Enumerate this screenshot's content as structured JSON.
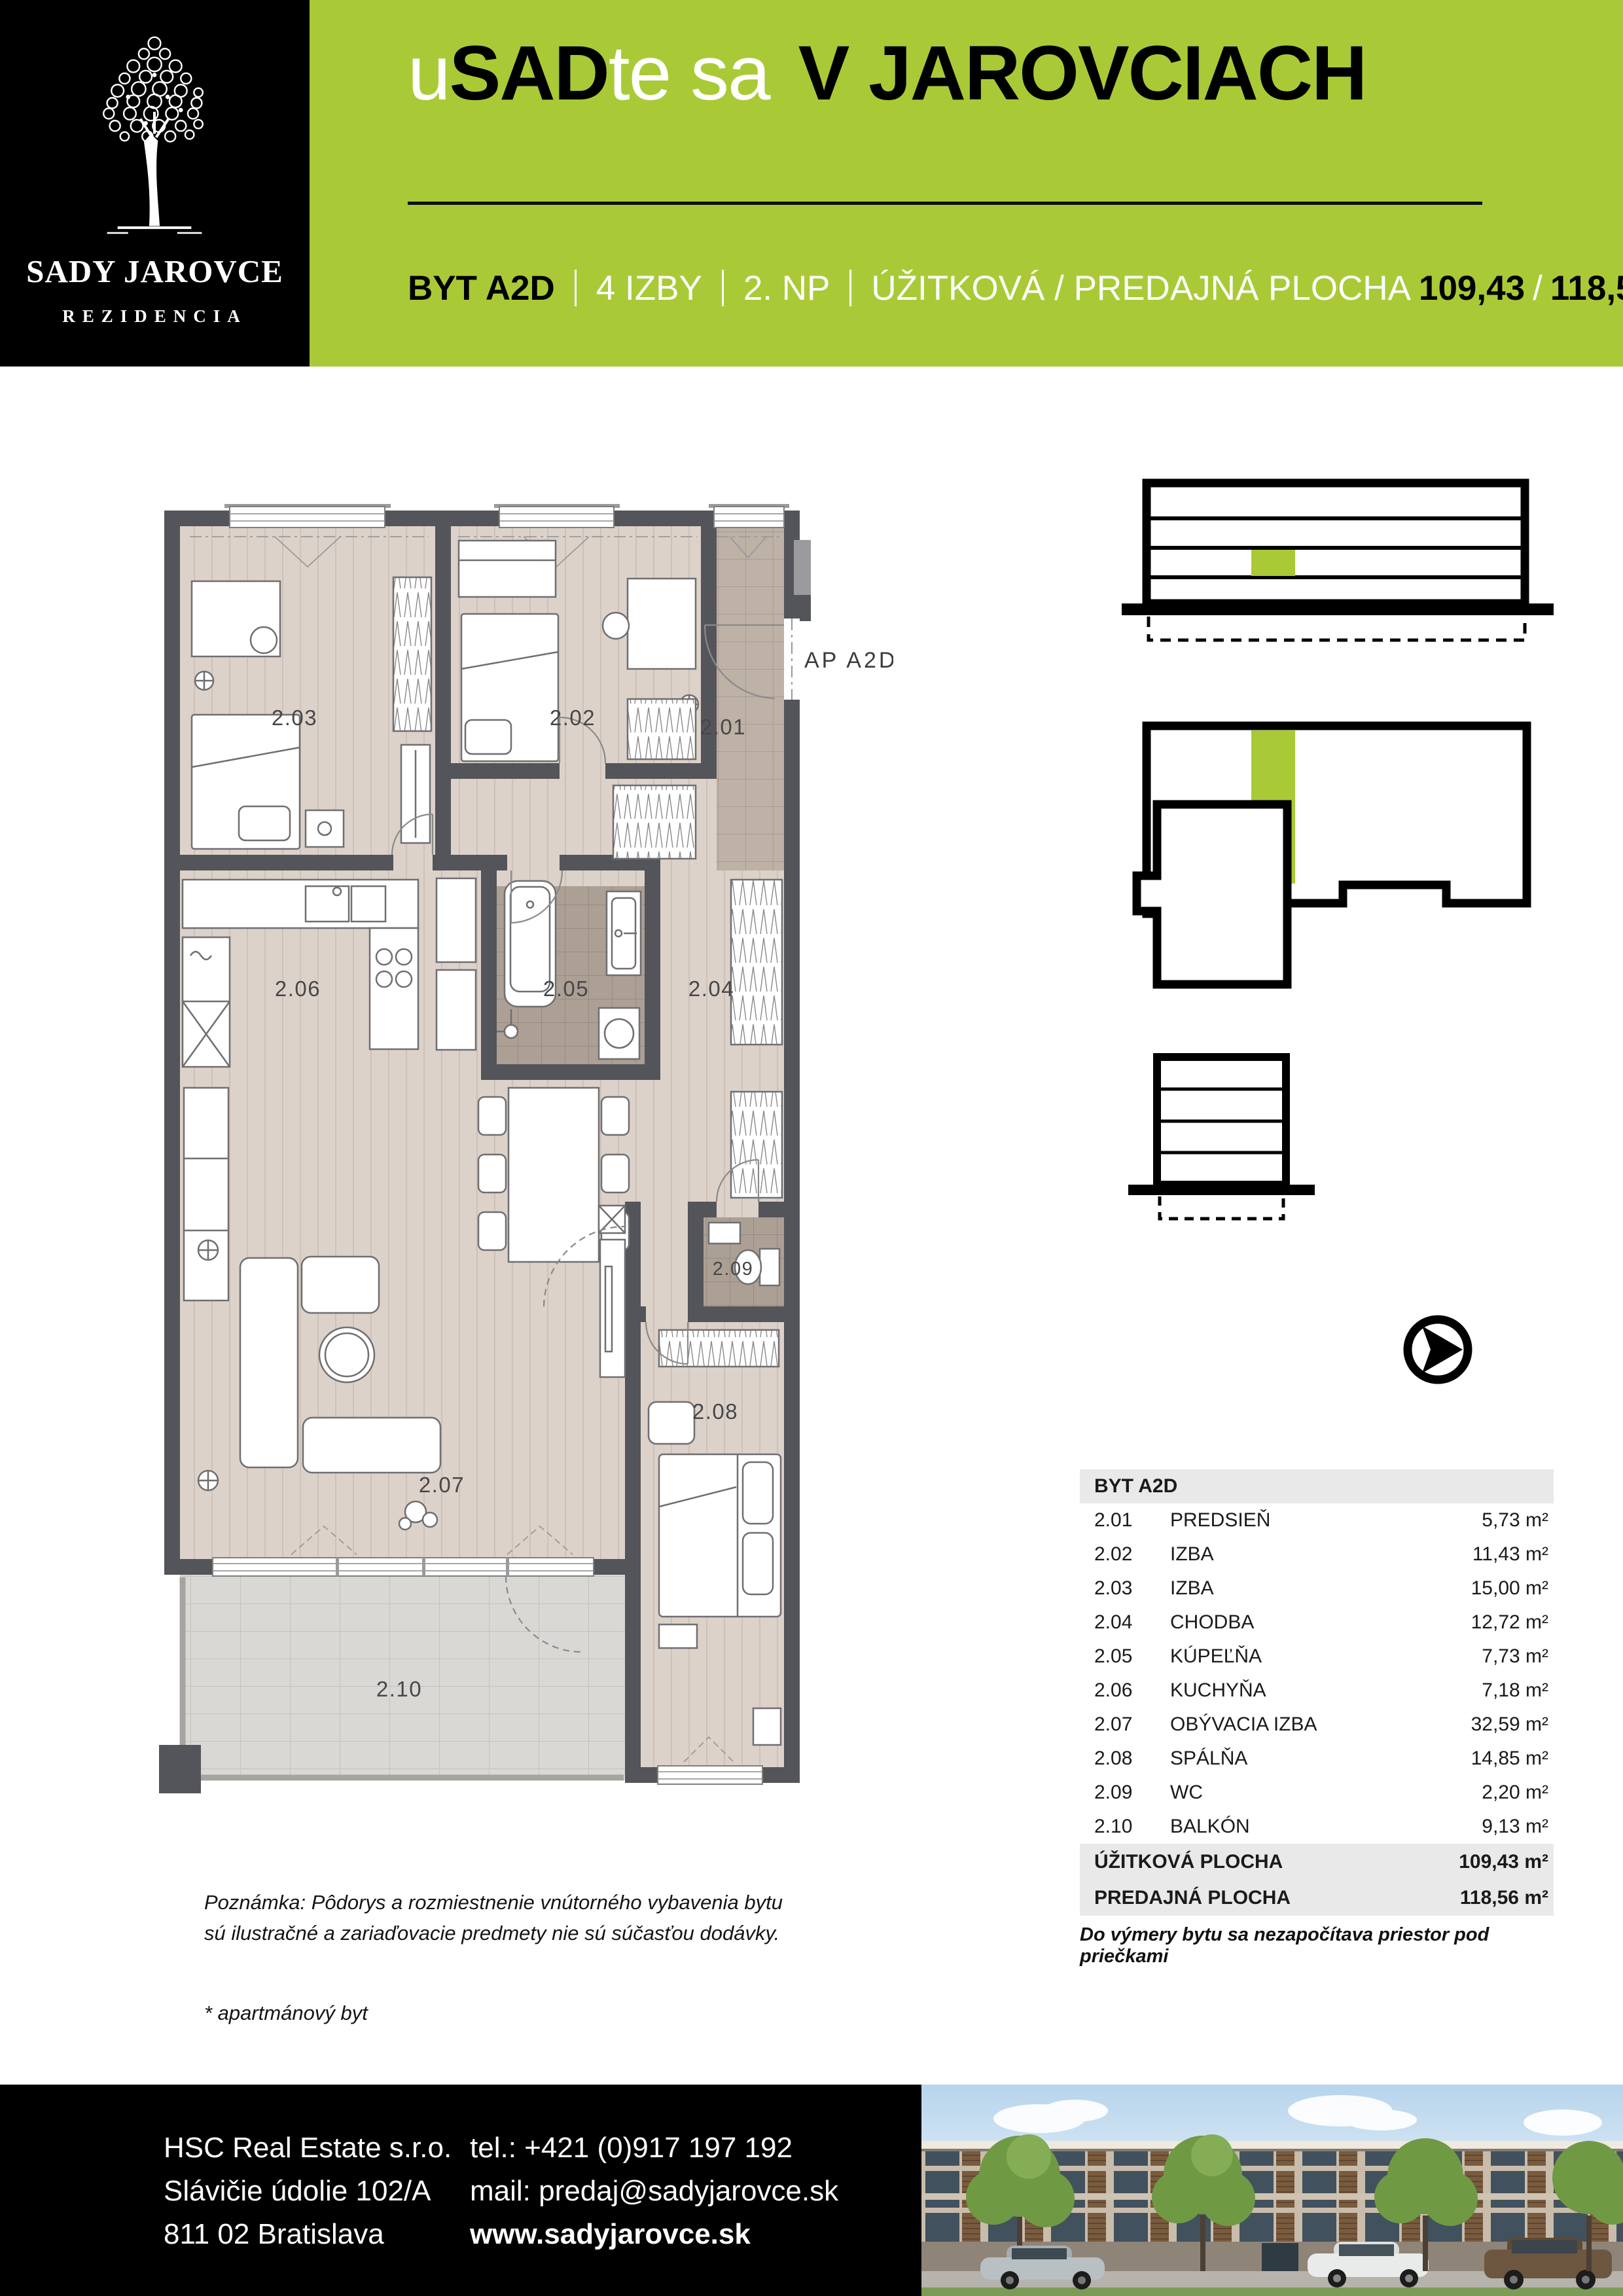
{
  "brand": {
    "logo_name": "SADY JAROVCE",
    "logo_subtitle": "REZIDENCIA",
    "green": "#a9ca36",
    "black": "#000000"
  },
  "header": {
    "title_u": "u",
    "title_sad": "SAD",
    "title_tesa": "te sa",
    "title_main": "V JAROVCIACH",
    "unit": "BYT A2D",
    "rooms": "4 IZBY",
    "floor": "2. NP",
    "area_label": "ÚŽITKOVÁ / PREDAJNÁ PLOCHA",
    "area_value_1": "109,43",
    "area_slash": "/",
    "area_value_2": "118,56 m²"
  },
  "plan": {
    "ap_label": "AP A2D",
    "rooms": [
      {
        "id": "2.01"
      },
      {
        "id": "2.02"
      },
      {
        "id": "2.03"
      },
      {
        "id": "2.04"
      },
      {
        "id": "2.05"
      },
      {
        "id": "2.06"
      },
      {
        "id": "2.07"
      },
      {
        "id": "2.08"
      },
      {
        "id": "2.09"
      },
      {
        "id": "2.10"
      }
    ]
  },
  "table": {
    "title": "BYT A2D",
    "rows": [
      {
        "code": "2.01",
        "name": "PREDSIEŇ",
        "area": "5,73 m²"
      },
      {
        "code": "2.02",
        "name": "IZBA",
        "area": "11,43 m²"
      },
      {
        "code": "2.03",
        "name": "IZBA",
        "area": "15,00 m²"
      },
      {
        "code": "2.04",
        "name": "CHODBA",
        "area": "12,72 m²"
      },
      {
        "code": "2.05",
        "name": "KÚPEĽŇA",
        "area": "7,73 m²"
      },
      {
        "code": "2.06",
        "name": "KUCHYŇA",
        "area": "7,18 m²"
      },
      {
        "code": "2.07",
        "name": "OBÝVACIA IZBA",
        "area": "32,59 m²"
      },
      {
        "code": "2.08",
        "name": "SPÁLŇA",
        "area": "14,85 m²"
      },
      {
        "code": "2.09",
        "name": "WC",
        "area": "2,20 m²"
      },
      {
        "code": "2.10",
        "name": "BALKÓN",
        "area": "9,13 m²"
      }
    ],
    "totals": [
      {
        "label": "ÚŽITKOVÁ PLOCHA",
        "area": "109,43 m²"
      },
      {
        "label": "PREDAJNÁ PLOCHA",
        "area": "118,56 m²"
      }
    ],
    "footnote": "Do výmery bytu sa nezapočítava priestor pod priečkami"
  },
  "notes": {
    "line1": "Poznámka: Pôdorys a rozmiestnenie vnútorného vybavenia bytu",
    "line2": "sú ilustračné a zariaďovacie predmety nie sú súčasťou dodávky.",
    "apartment": "* apartmánový byt"
  },
  "footer": {
    "company": "HSC Real Estate s.r.o.",
    "street": "Slávičie údolie 102/A",
    "city": "811 02 Bratislava",
    "tel": "tel.: +421 (0)917 197 192",
    "mail": "mail: predaj@sadyjarovce.sk",
    "web": "www.sadyjarovce.sk"
  }
}
